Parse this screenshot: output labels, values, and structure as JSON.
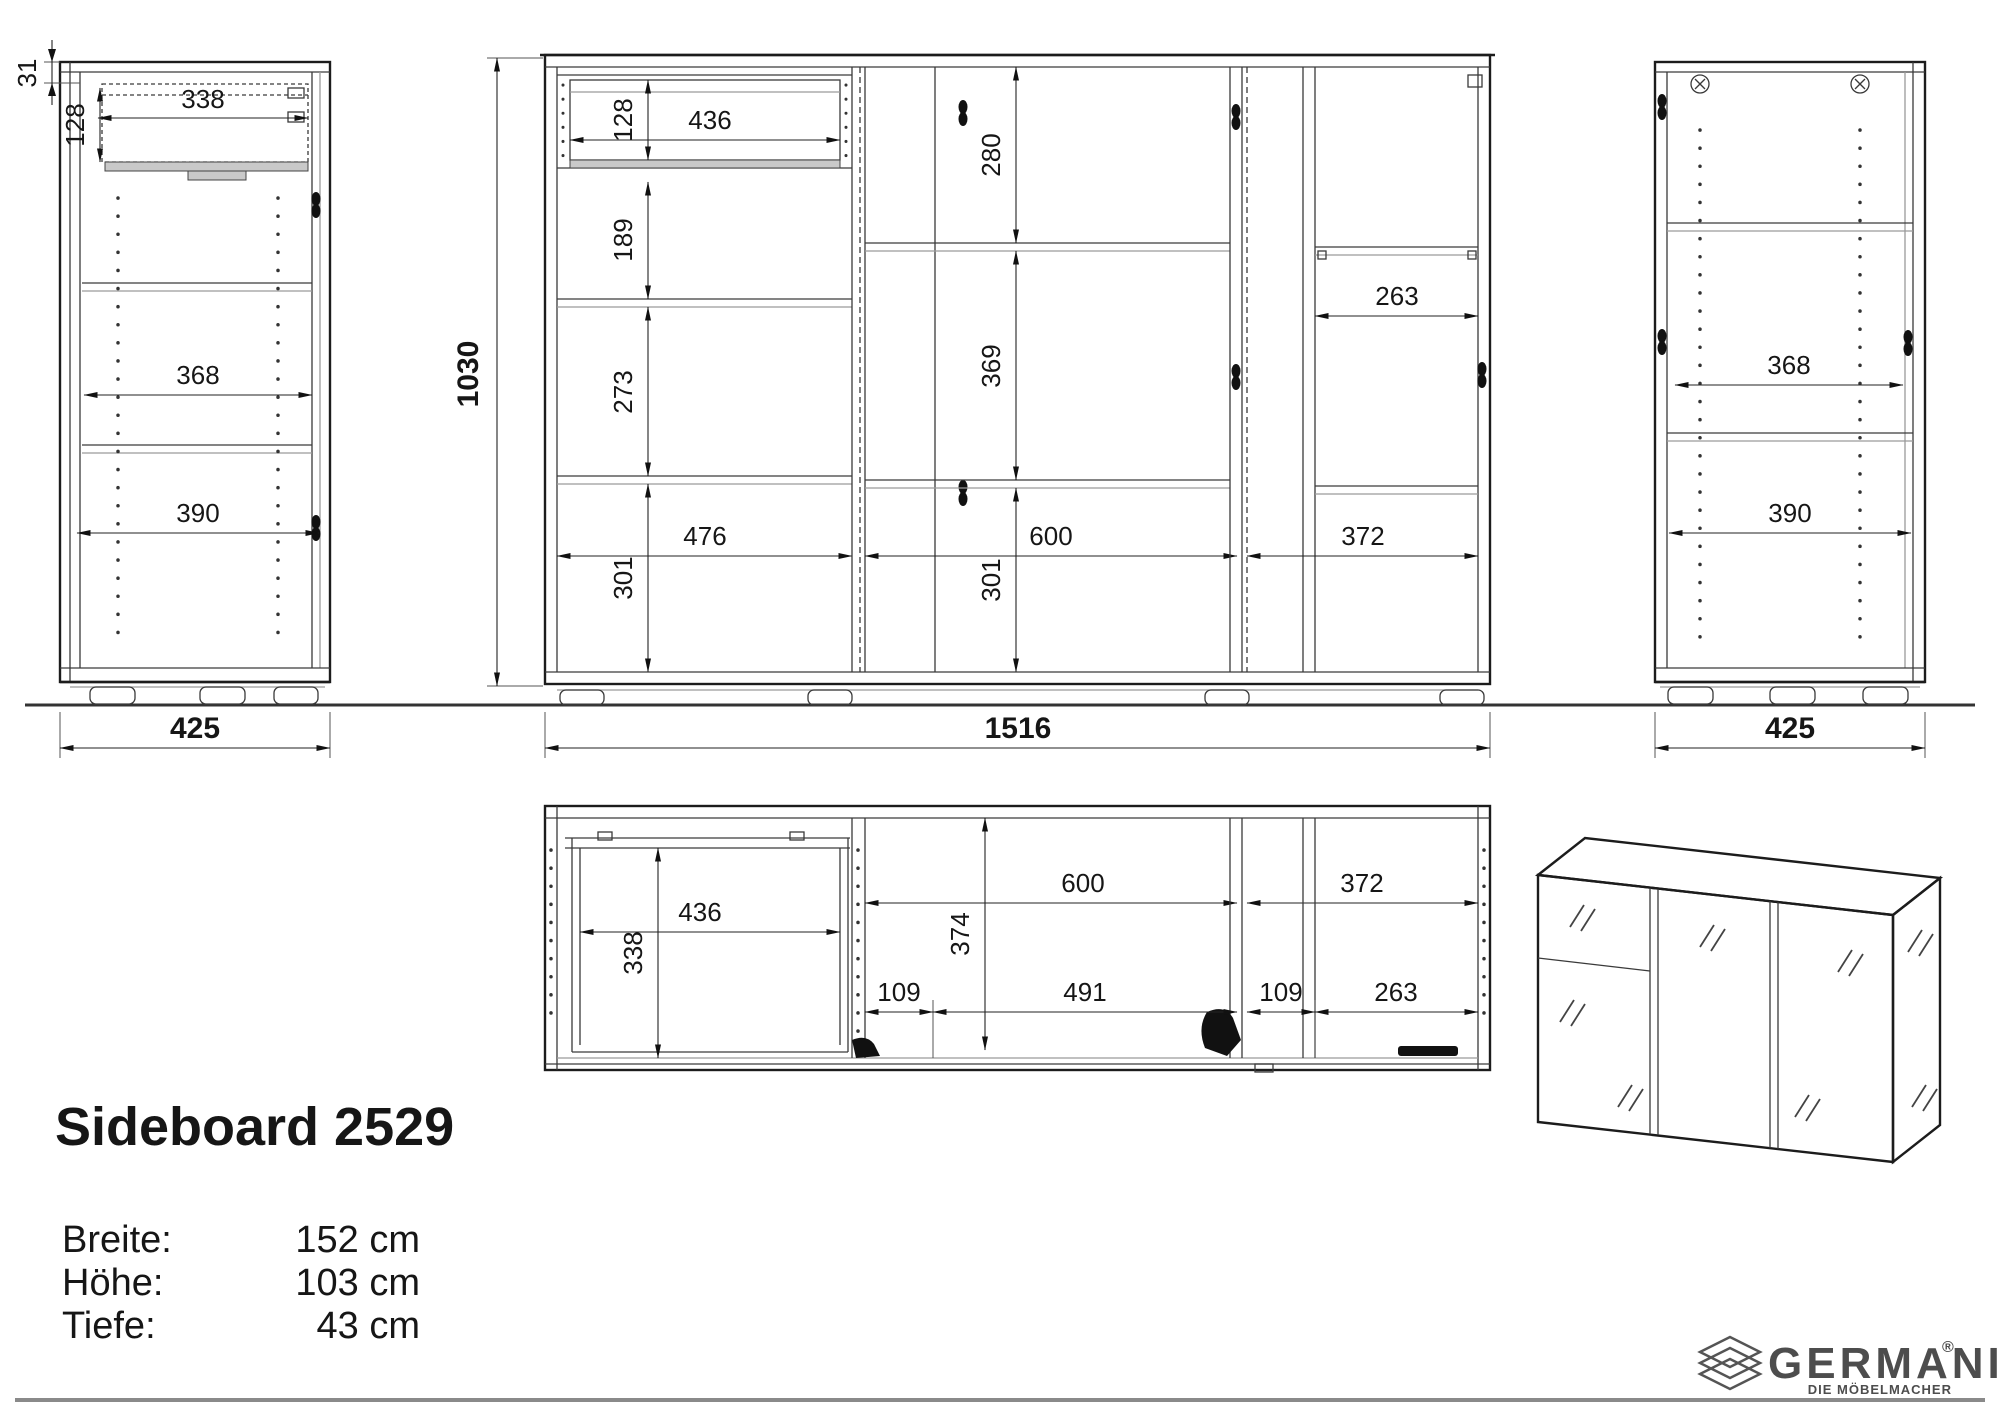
{
  "title": "Sideboard 2529",
  "specs": {
    "breite_label": "Breite:",
    "breite_value": "152 cm",
    "hoehe_label": "Höhe:",
    "hoehe_value": "103 cm",
    "tiefe_label": "Tiefe:",
    "tiefe_value": "43 cm"
  },
  "views": {
    "left_side": {
      "d31": "31",
      "d128": "128",
      "d338": "338",
      "d368": "368",
      "d390": "390",
      "d425": "425"
    },
    "front": {
      "d1030": "1030",
      "d128": "128",
      "d436": "436",
      "d189": "189",
      "d273": "273",
      "d476": "476",
      "d301_left": "301",
      "d280": "280",
      "d369": "369",
      "d600": "600",
      "d301_mid": "301",
      "d263": "263",
      "d372": "372",
      "d1516": "1516"
    },
    "right_side": {
      "d368": "368",
      "d390": "390",
      "d425": "425"
    },
    "top": {
      "d436": "436",
      "d338": "338",
      "d374": "374",
      "d600": "600",
      "d372": "372",
      "d109_left": "109",
      "d491": "491",
      "d109_right": "109",
      "d263": "263"
    }
  },
  "logo": {
    "brand": "GERMANIA",
    "registered": "®",
    "tagline": "DIE MÖBELMACHER"
  }
}
